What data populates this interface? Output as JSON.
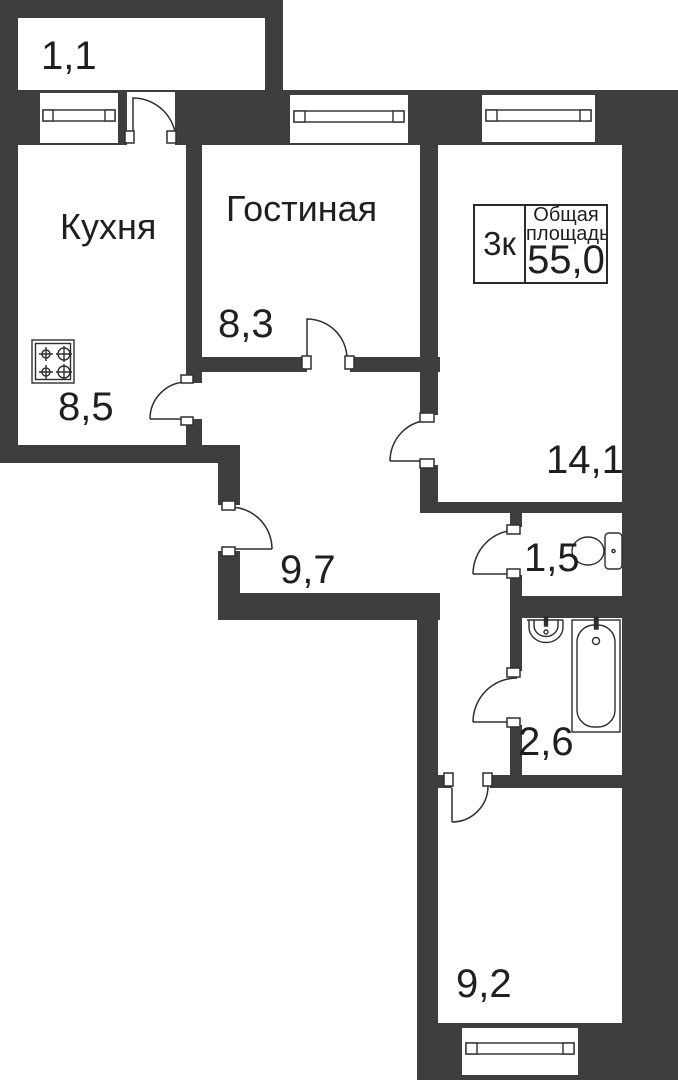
{
  "plan": {
    "type": "apartment-floor-plan",
    "colors": {
      "wall": "#3e3e3e",
      "line": "#2e2e2e",
      "text": "#1f1f1f",
      "background": "#ffffff"
    }
  },
  "info_box": {
    "rooms": "3к",
    "label1": "Общая",
    "label2": "площадь",
    "value": "55,0"
  },
  "rooms": [
    {
      "id": "balcony",
      "name": "",
      "area": "1,1"
    },
    {
      "id": "kitchen",
      "name": "Кухня",
      "area": "8,5"
    },
    {
      "id": "living",
      "name": "Гостиная",
      "area": "8,3"
    },
    {
      "id": "bedroom1",
      "name": "",
      "area": "14,1"
    },
    {
      "id": "hall",
      "name": "",
      "area": "9,7"
    },
    {
      "id": "wc",
      "name": "",
      "area": "1,5"
    },
    {
      "id": "bathroom",
      "name": "",
      "area": "2,6"
    },
    {
      "id": "bedroom2",
      "name": "",
      "area": "9,2"
    }
  ],
  "fixtures": [
    "stove-icon",
    "sink-icon",
    "bathtub-icon",
    "toilet-icon"
  ],
  "windows_count": 4,
  "doors_count": 8
}
